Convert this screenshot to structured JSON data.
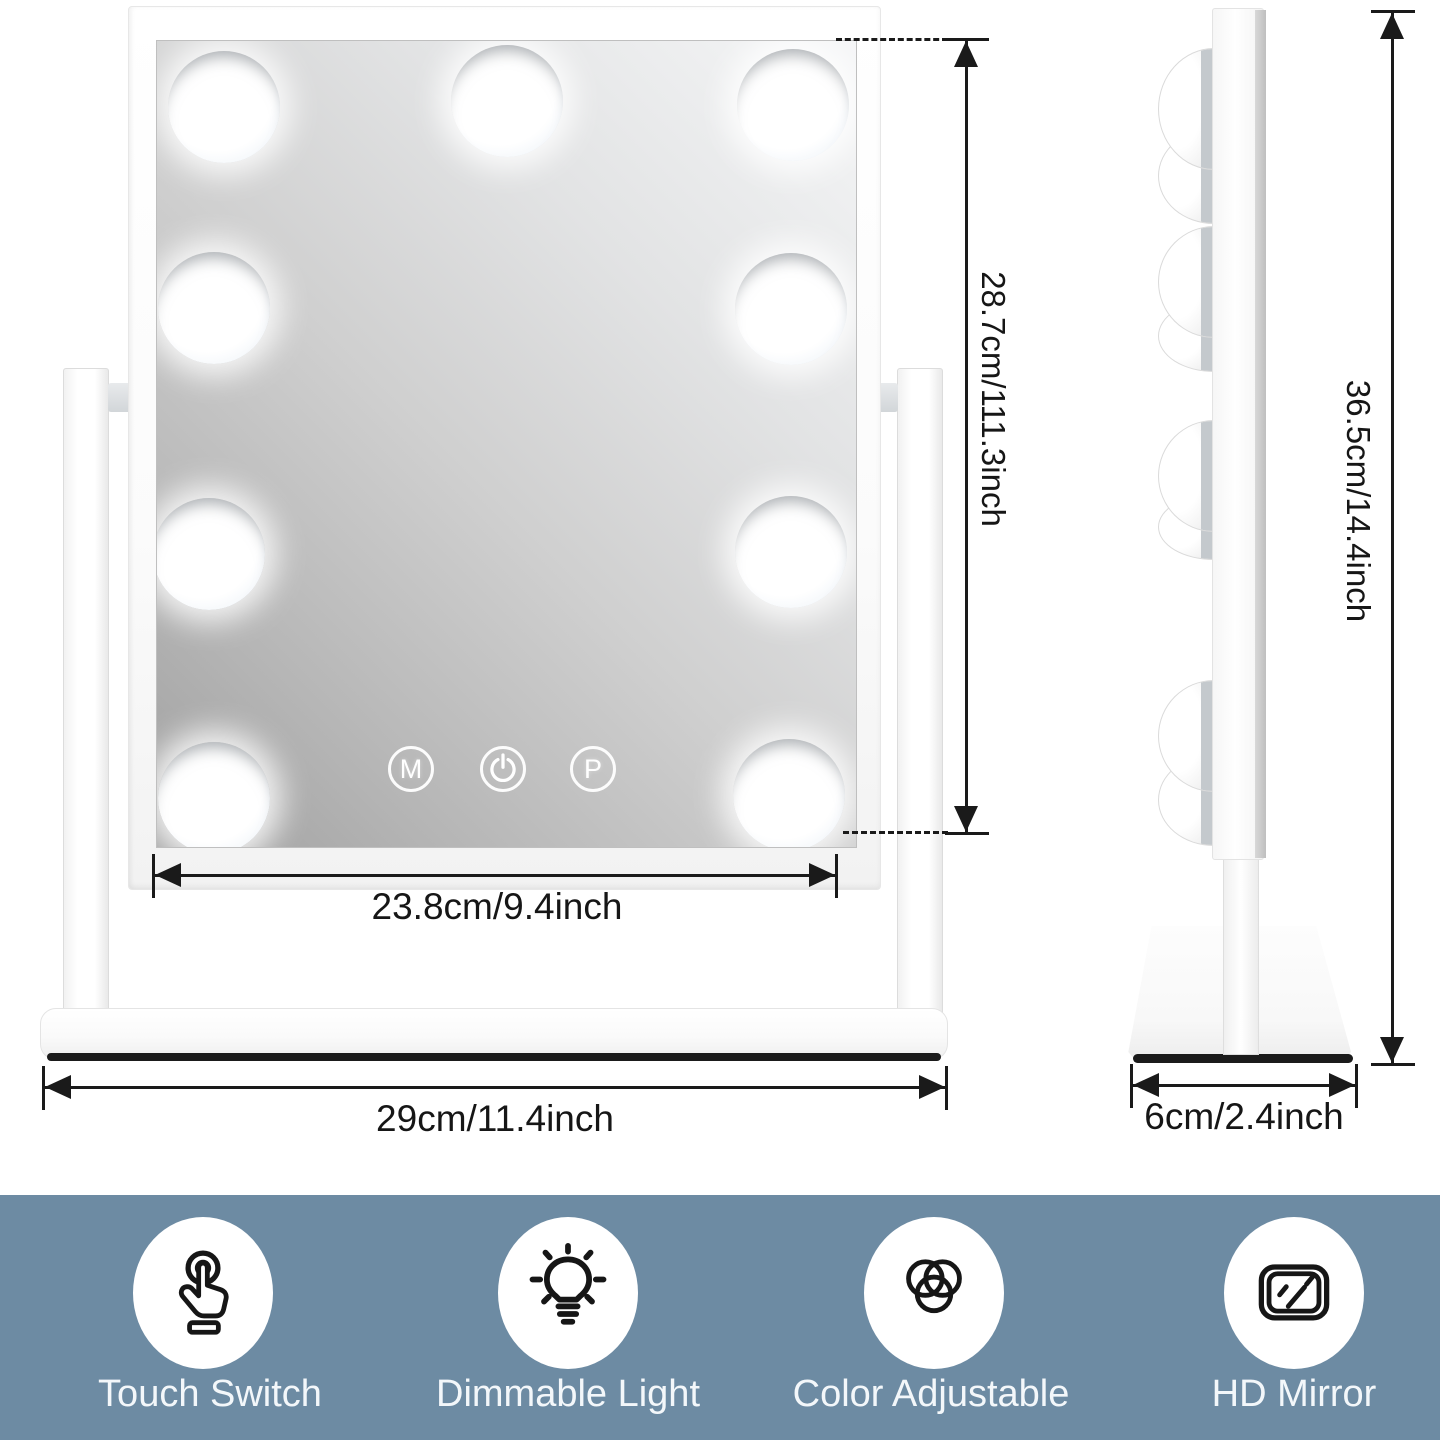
{
  "front_view": {
    "touch_buttons": {
      "mode_label": "M",
      "preset_label": "P"
    },
    "dim_mirror_height": "28.7cm/111.3inch",
    "dim_mirror_width": "23.8cm/9.4inch",
    "dim_base_width": "29cm/11.4inch"
  },
  "side_view": {
    "dim_total_height": "36.5cm/14.4inch",
    "dim_base_depth": "6cm/2.4inch"
  },
  "features": [
    {
      "icon": "touch-switch-icon",
      "label": "Touch Switch"
    },
    {
      "icon": "dimmable-light-icon",
      "label": "Dimmable Light"
    },
    {
      "icon": "color-adjustable-icon",
      "label": "Color Adjustable"
    },
    {
      "icon": "hd-mirror-icon",
      "label": "HD Mirror"
    }
  ],
  "colors": {
    "background": "#ffffff",
    "feature_band": "#6d8ba3",
    "annotation": "#1a1a1a",
    "product_white": "#fdfdfd",
    "mirror_gray_light": "#f5f6f7",
    "mirror_gray_dark": "#a0a0a0",
    "base_edge_dark": "#1b1b1b"
  }
}
